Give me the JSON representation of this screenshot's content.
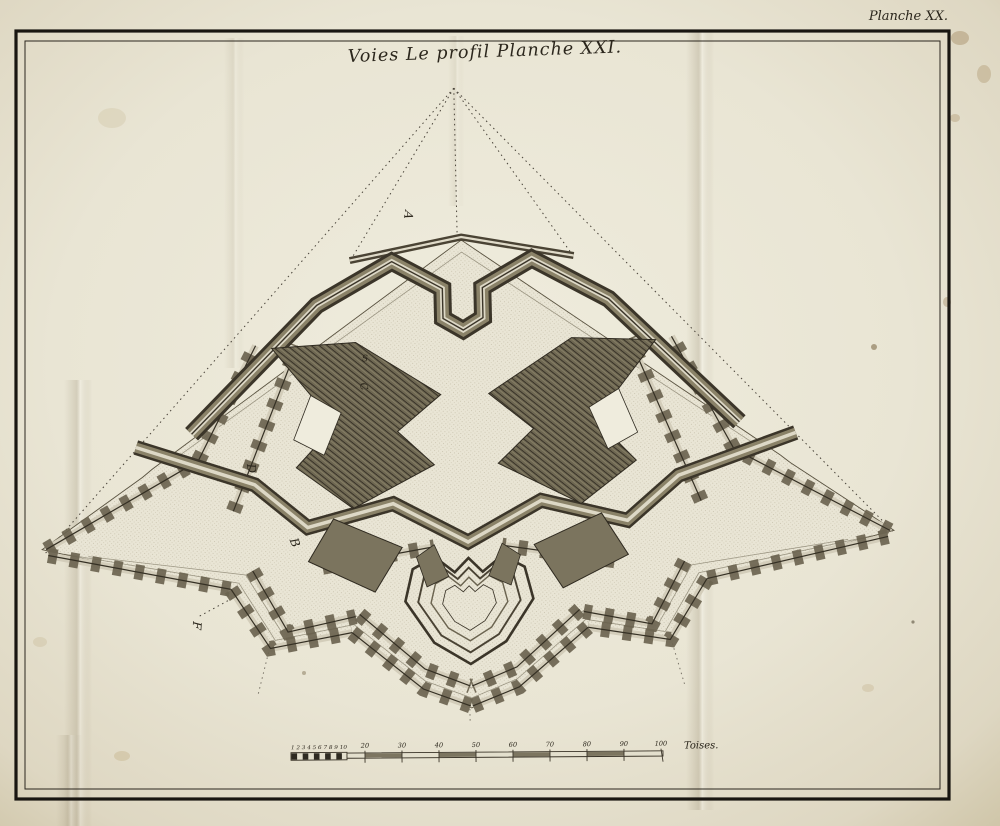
{
  "page": {
    "plate_label": "Planche XX.",
    "title": "Voies Le profil Planche XXI."
  },
  "plan": {
    "description": "engraved star-fortification plan",
    "reference_letters": [
      "A",
      "S",
      "C",
      "D",
      "B",
      "F"
    ]
  },
  "scale_bar": {
    "subdivision_digits": "1 2 3 4 5 6 7 8 9 10",
    "tick_labels": [
      "20",
      "30",
      "40",
      "50",
      "60",
      "70",
      "80",
      "90",
      "100"
    ],
    "unit_label": "Toises."
  },
  "palette": {
    "paper": "#e9e5d5",
    "ink": "#2b261c",
    "band_olive": "#8a8268",
    "band_dark": "#3b3529",
    "band_light": "#ddd8c6"
  }
}
